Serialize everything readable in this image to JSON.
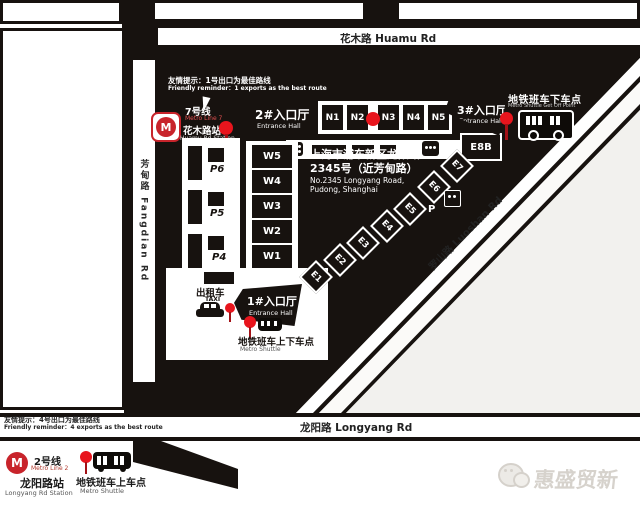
{
  "roads": {
    "huamu": "花木路 Huamu Rd",
    "longyang": "龙阳路 Longyang Rd",
    "luoshan": "罗山路 Luoshan Rd",
    "fangdian": "芳甸路 Fangdian Rd"
  },
  "reminders": {
    "top_cn": "友情提示：1号出口为最佳路线",
    "top_en": "Friendly reminder：1 exports as the best route",
    "bottom_cn": "友情提示：4号出口为最佳路线",
    "bottom_en": "Friendly reminder：4 exports as the best route"
  },
  "stations": {
    "line7": {
      "line_cn": "7号线",
      "line_en": "Metro Line 7",
      "station_cn": "花木路站",
      "station_en": "Huamu Rd Station",
      "logo_letter": "M"
    },
    "line2": {
      "line_cn": "2号线",
      "line_en": "Metro Line 2",
      "station_cn": "龙阳路站",
      "station_en": "Longyang Rd Station",
      "logo_letter": "M"
    }
  },
  "entrances": {
    "hall1": {
      "cn": "1#入口厅",
      "en": "Entrance Hall"
    },
    "hall2": {
      "cn": "2#入口厅",
      "en": "Entrance Hall"
    },
    "hall3": {
      "cn": "3#入口厅",
      "en": "Entrance Hall"
    }
  },
  "shuttle": {
    "dropoff_cn": "地铁班车下车点",
    "dropoff_en": "Metro Shuttle Get Off Point",
    "updown_cn": "地铁班车上下车点",
    "updown_en": "Metro Shuttle",
    "pickup_cn": "地铁班车上车点",
    "pickup_en": "Metro Shuttle"
  },
  "address": {
    "line1": "上海市浦东新区龙阳路",
    "line2": "2345号（近芳甸路）",
    "line3": "No.2345 Longyang Road,",
    "line4": "Pudong, Shanghai"
  },
  "buildings": {
    "north": [
      "N1",
      "N2",
      "N3",
      "N4",
      "N5"
    ],
    "west": [
      "W5",
      "W4",
      "W3",
      "W2",
      "W1"
    ],
    "east": [
      "E1",
      "E2",
      "E3",
      "E4",
      "E5",
      "E6",
      "E7"
    ],
    "e8b": "E8B"
  },
  "parking": {
    "p6": "P6",
    "p5": "P5",
    "p4": "P4",
    "p_east": "P"
  },
  "taxi": {
    "cn": "出租车",
    "en": "TAXI"
  },
  "watermark": "惠盛贸新",
  "colors": {
    "expo_black": "#17120f",
    "metro_red": "#c8242b",
    "pin_red": "#e8151d",
    "area_gray": "#f2f1ee"
  }
}
